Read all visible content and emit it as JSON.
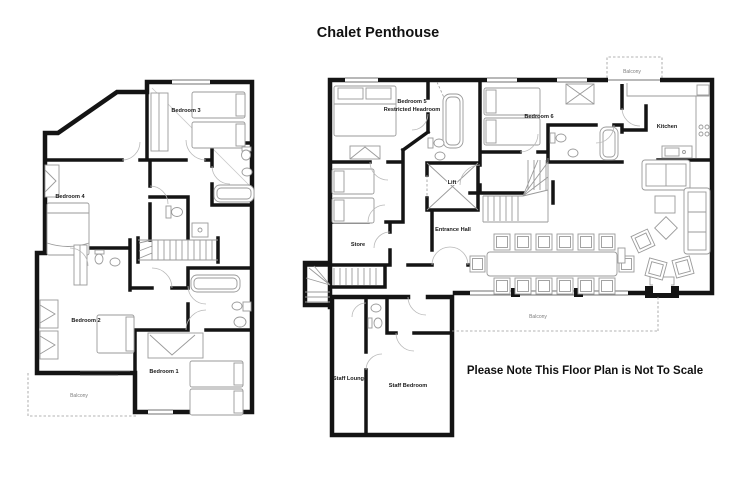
{
  "title": "Chalet Penthouse",
  "note": "Please Note This Floor Plan is Not To Scale",
  "colors": {
    "wall": "#141414",
    "furniture": "#9a9a9a",
    "room_label": "#1a1a1a",
    "balcony_label": "#7d7d7d",
    "background": "#ffffff"
  },
  "left_plan": {
    "labels": {
      "bedroom3": "Bedroom 3",
      "bedroom4": "Bedroom 4",
      "bedroom2": "Bedroom 2",
      "bedroom1": "Bedroom 1",
      "balcony": "Balcony"
    }
  },
  "right_plan": {
    "labels": {
      "bedroom5_line1": "Bedroom 5",
      "bedroom5_line2": "Restricted Headroom",
      "bedroom6": "Bedroom 6",
      "kitchen": "Kitchen",
      "lift": "Lift",
      "store": "Store",
      "entrance_hall": "Entrance Hall",
      "balcony_top": "Balcony",
      "balcony_bottom": "Balcony",
      "staff_lounge": "Staff Lounge",
      "staff_bedroom": "Staff Bedroom"
    }
  }
}
